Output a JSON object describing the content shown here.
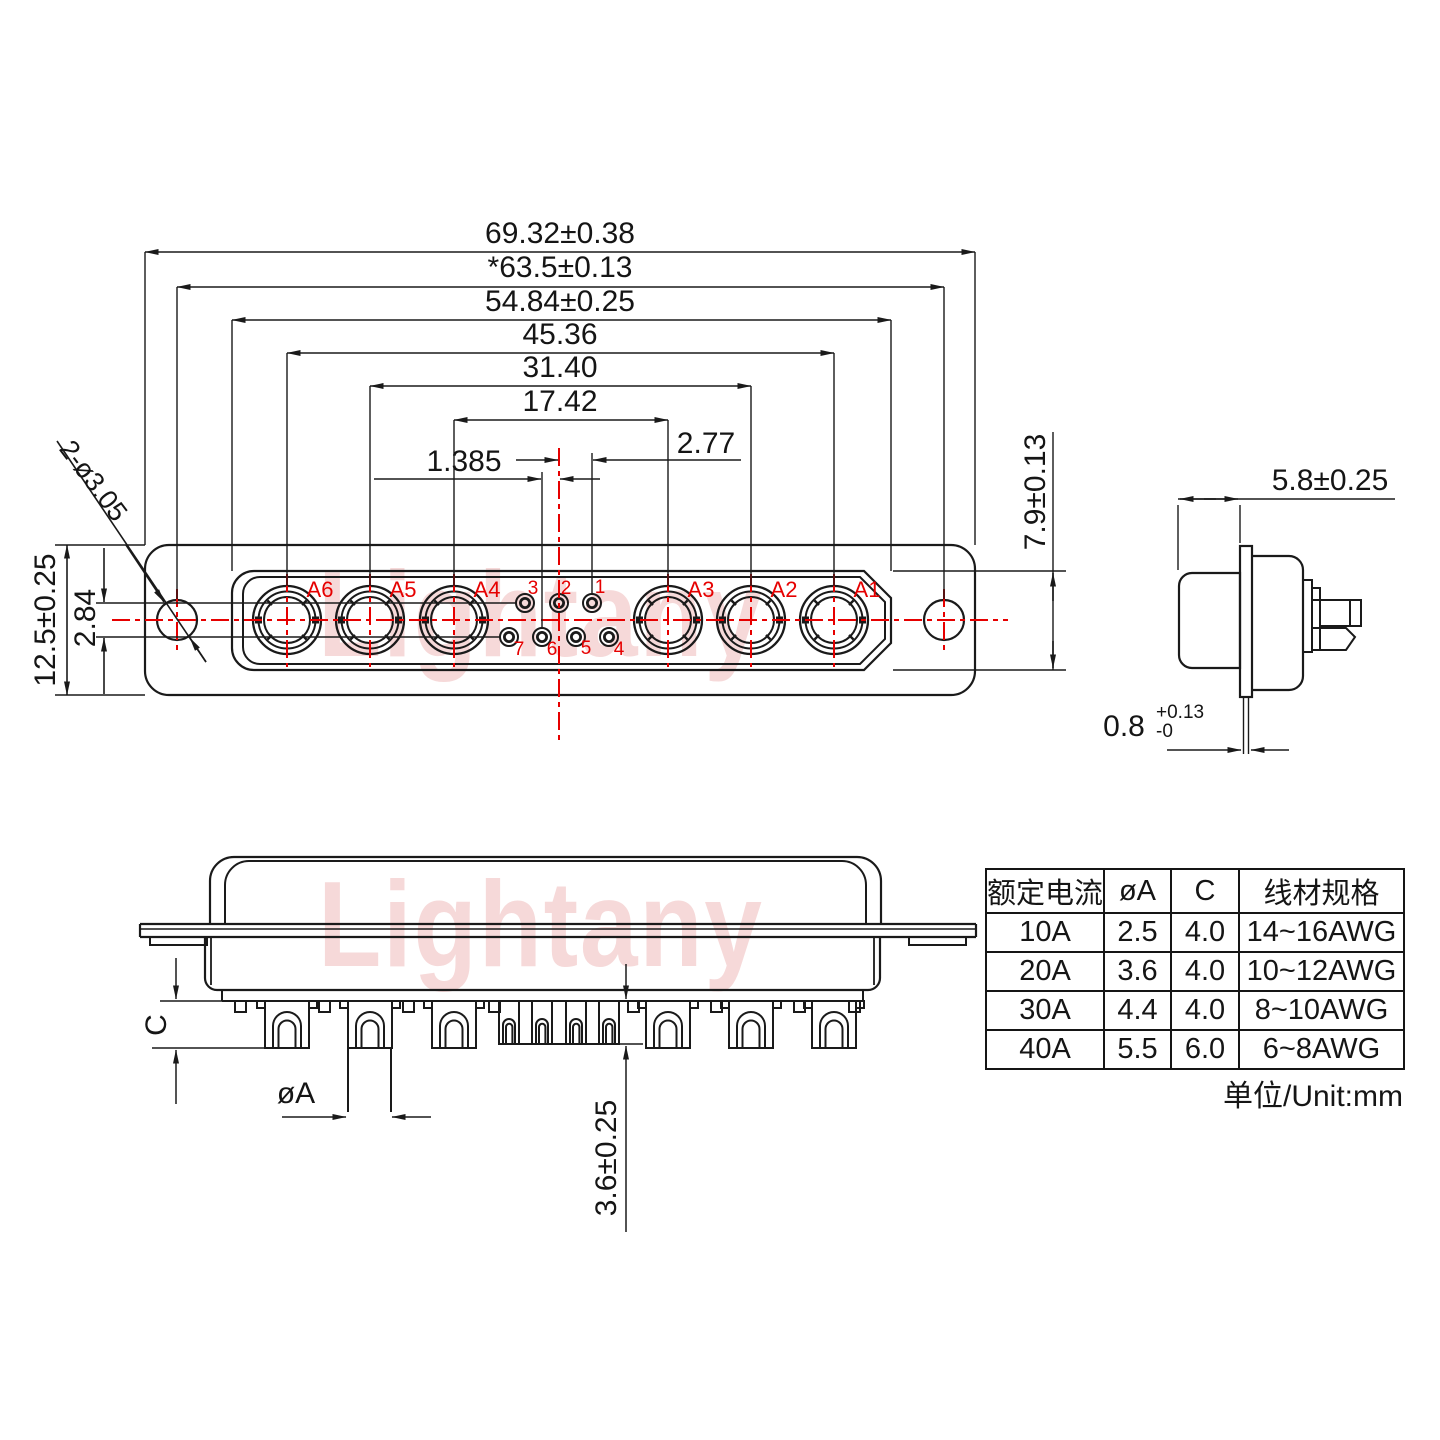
{
  "branding": {
    "watermark": "Lightany"
  },
  "colors": {
    "line": "#1a1a1a",
    "accent_red": "#e60000",
    "watermark_pink": "#eeb4b4"
  },
  "top_view": {
    "dims": {
      "overall_width": "69.32±0.38",
      "mount_hole_span": "*63.5±0.13",
      "shroud_width": "54.84±0.25",
      "contact_span_outer": "45.36",
      "contact_span_mid": "31.40",
      "contact_span_inner": "17.42",
      "pin_pitch": "2.77",
      "pin_half_pitch": "1.385",
      "plate_height": "12.5±0.25",
      "row_spacing": "2.84",
      "shroud_height": "7.9±0.13",
      "mount_hole_note": "2-ø3.05"
    },
    "contact_labels": [
      "A6",
      "A5",
      "A4",
      "A3",
      "A2",
      "A1"
    ],
    "pin_labels_top": [
      "3",
      "2",
      "1"
    ],
    "pin_labels_bottom": [
      "7",
      "6",
      "5",
      "4"
    ]
  },
  "side_view": {
    "dims": {
      "front_depth": "5.8±0.25",
      "flange_thickness": "0.8",
      "flange_tol_plus": "+0.13",
      "flange_tol_minus": "-0"
    }
  },
  "bottom_view": {
    "dims": {
      "cup_depth": "C",
      "cup_diameter": "øA",
      "tail_length": "3.6±0.25"
    }
  },
  "spec_table": {
    "headers": [
      "额定电流",
      "øA",
      "C",
      "线材规格"
    ],
    "rows": [
      {
        "current": "10A",
        "dia": "2.5",
        "c": "4.0",
        "wire": "14~16AWG"
      },
      {
        "current": "20A",
        "dia": "3.6",
        "c": "4.0",
        "wire": "10~12AWG"
      },
      {
        "current": "30A",
        "dia": "4.4",
        "c": "4.0",
        "wire": "8~10AWG"
      },
      {
        "current": "40A",
        "dia": "5.5",
        "c": "6.0",
        "wire": "6~8AWG"
      }
    ],
    "unit_note": "单位/Unit:mm"
  }
}
